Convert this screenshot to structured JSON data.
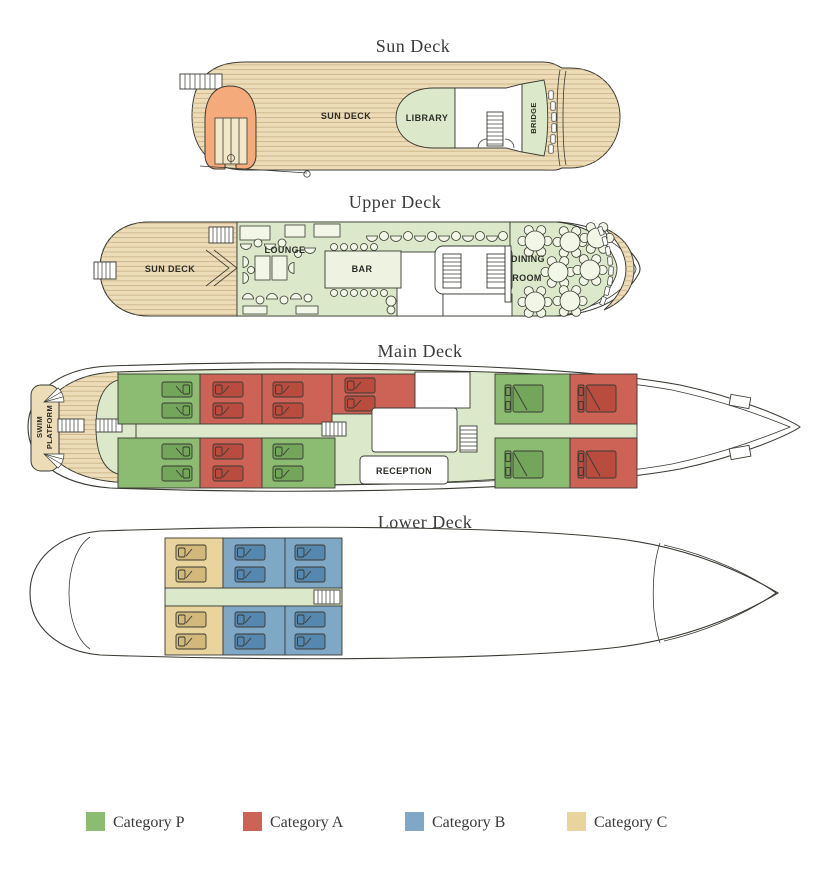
{
  "page": {
    "background": "#ffffff"
  },
  "decks": {
    "sun": {
      "title": "Sun Deck",
      "labels": {
        "deck": "SUN DECK",
        "library": "LIBRARY",
        "bridge": "BRIDGE"
      }
    },
    "upper": {
      "title": "Upper Deck",
      "labels": {
        "sun_deck": "SUN DECK",
        "lounge": "LOUNGE",
        "bar": "BAR",
        "dining1": "DINING",
        "dining2": "ROOM"
      }
    },
    "main": {
      "title": "Main Deck",
      "labels": {
        "swim1": "SWIM",
        "swim2": "PLATFORM",
        "reception": "RECEPTION"
      },
      "cabins": [
        {
          "cat": "P"
        },
        {
          "cat": "A"
        },
        {
          "cat": "A"
        },
        {
          "cat": "A"
        },
        {
          "cat": "P"
        },
        {
          "cat": "A"
        },
        {
          "cat": "P"
        },
        {
          "cat": "A"
        },
        {
          "cat": "P"
        },
        {
          "cat": "P"
        },
        {
          "cat": "A"
        }
      ]
    },
    "lower": {
      "title": "Lower Deck",
      "cabins": [
        {
          "cat": "C"
        },
        {
          "cat": "B"
        },
        {
          "cat": "B"
        },
        {
          "cat": "C"
        },
        {
          "cat": "B"
        },
        {
          "cat": "B"
        }
      ]
    }
  },
  "legend": {
    "items": [
      {
        "key": "P",
        "label": "Category P",
        "color": "#8cbb72",
        "bed_color": "#73a55a"
      },
      {
        "key": "A",
        "label": "Category A",
        "color": "#cd6356",
        "bed_color": "#b94c3f"
      },
      {
        "key": "B",
        "label": "Category B",
        "color": "#7fa8c6",
        "bed_color": "#5687ae"
      },
      {
        "key": "C",
        "label": "Category C",
        "color": "#e8d49c",
        "bed_color": "#d2b87a"
      }
    ]
  },
  "colors": {
    "outline": "#3a3a33",
    "wood": "#ecdcb8",
    "wood-line": "#c8af82",
    "room": "#dbe9ca",
    "bar-fill": "#edf3e0",
    "furniture": "#f1f6e6",
    "boat": "#f5aa7b",
    "boat-inner": "#f3e7c9",
    "ink-title": "#3a3a3a",
    "ink-label": "#2c2c27"
  }
}
